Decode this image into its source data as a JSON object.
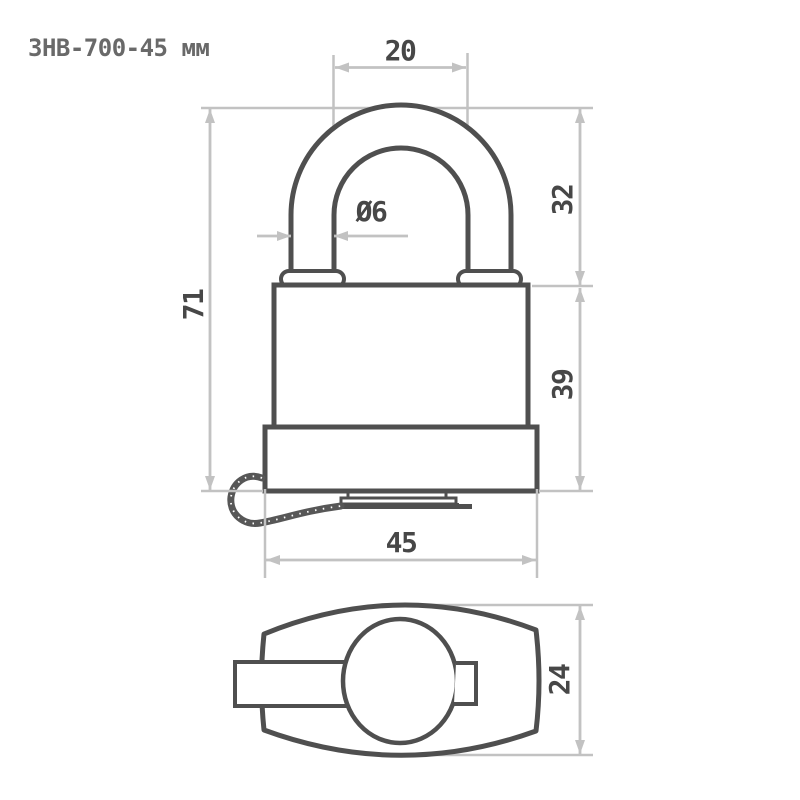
{
  "title": "ЗНВ-700-45 мм",
  "drawing": {
    "kind": "padlock technical drawing, front view and bottom view",
    "dimensions": {
      "shackle_inner_width": "20",
      "shackle_rod_diameter": "Ø6",
      "shackle_height": "32",
      "total_height": "71",
      "body_height": "39",
      "body_width": "45",
      "body_depth": "24"
    }
  },
  "colors": {
    "outline": "#4f4f4f",
    "dimension_lines": "#c2c2c2",
    "dimension_text": "#474747",
    "title_text": "#696969",
    "background": "#ffffff"
  }
}
